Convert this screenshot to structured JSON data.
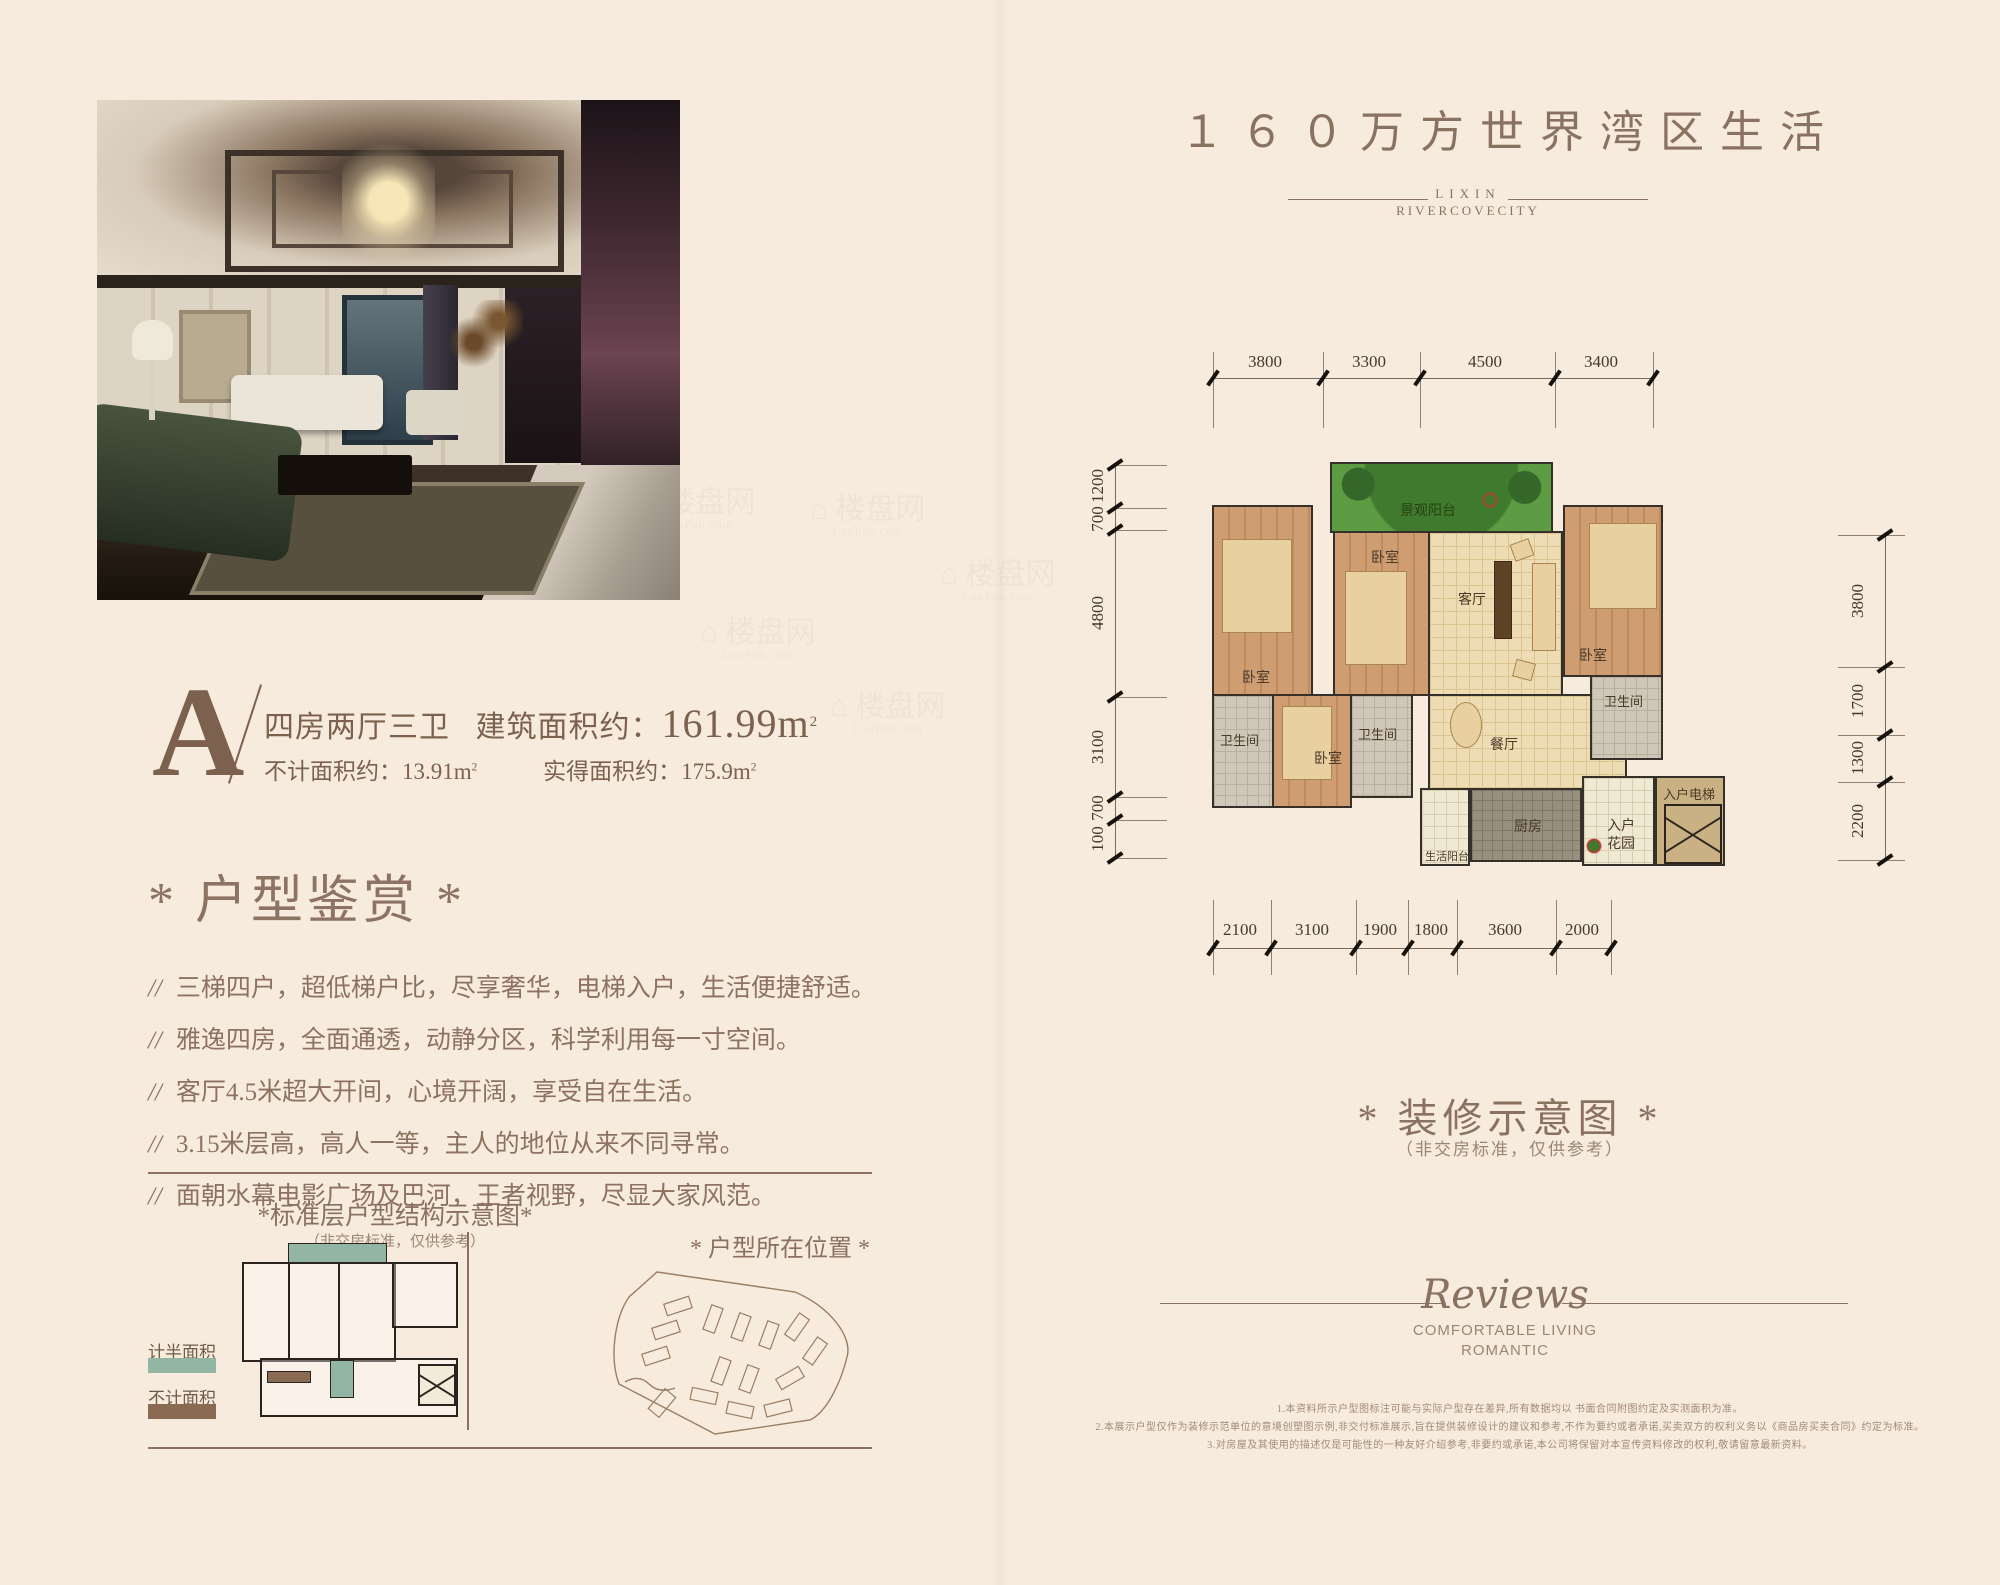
{
  "page": {
    "background": "#f7ebdd",
    "accent": "#8a7262"
  },
  "watermark": {
    "name": "楼盘网",
    "domain": "LouPan.com"
  },
  "header": {
    "title": "１６０万方世界湾区生活",
    "brand_top": "LIXIN",
    "brand_bottom": "RIVERCOVECITY"
  },
  "unit": {
    "letter": "A",
    "type": "四房两厅三卫",
    "area_label": "建筑面积约：",
    "area_value": "161.99m",
    "sup": "2",
    "sub1_label": "不计面积约：",
    "sub1_value": "13.91m",
    "sub2_label": "实得面积约：",
    "sub2_value": "175.9m"
  },
  "appreciation": {
    "title": "* 户型鉴赏 *",
    "marker": "//",
    "bullets": [
      "三梯四户，超低梯户比，尽享奢华，电梯入户，生活便捷舒适。",
      "雅逸四房，全面通透，动静分区，科学利用每一寸空间。",
      "客厅4.5米超大开间，心境开阔，享受自在生活。",
      "3.15米层高，高人一等，主人的地位从来不同寻常。",
      "面朝水幕电影广场及巴河，王者视野，尽显大家风范。"
    ]
  },
  "diagrams": {
    "structure_title": "*标准层户型结构示意图*",
    "structure_note": "（非交房标准，仅供参考）",
    "location_title": "* 户型所在位置 *",
    "legend": [
      {
        "label": "计半面积",
        "color": "#93b5a4"
      },
      {
        "label": "不计面积",
        "color": "#8a6a52"
      }
    ]
  },
  "floorplan": {
    "rooms": {
      "balcony": "景观阳台",
      "bedroom": "卧室",
      "living": "客厅",
      "dining": "餐厅",
      "bath": "卫生间",
      "kitchen": "厨房",
      "entry_garden": "入户花园",
      "life_balcony": "生活阳台",
      "elevator": "入户电梯"
    },
    "dims_top": [
      "3800",
      "3300",
      "4500",
      "3400"
    ],
    "dims_bottom": [
      "2100",
      "3100",
      "1900",
      "1800",
      "3600",
      "2000"
    ],
    "dims_left": [
      "1200",
      "700",
      "4800",
      "3100",
      "700",
      "100"
    ],
    "dims_right": [
      "3800",
      "1700",
      "1300",
      "2200"
    ]
  },
  "decor": {
    "title": "* 装修示意图 *",
    "note": "（非交房标准，仅供参考）"
  },
  "reviews": {
    "word": "Reviews",
    "line1": "COMFORTABLE LIVING",
    "line2": "ROMANTIC"
  },
  "disclaimer": [
    "1.本资料所示户型图标注可能与实际户型存在差异,所有数据均以 书面合同附图约定及实测面积为准。",
    "2.本展示户型仅作为装修示范单位的意境创塑图示例,非交付标准展示,旨在提供装修设计的建议和参考,不作为要约或者承诺,买卖双方的权利义务以《商品房买卖合同》约定为标准。",
    "3.对房屋及其使用的描述仅是可能性的一种友好介绍参考,非要约或承诺,本公司将保留对本宣传资料修改的权利,敬请留意最新资料。"
  ]
}
